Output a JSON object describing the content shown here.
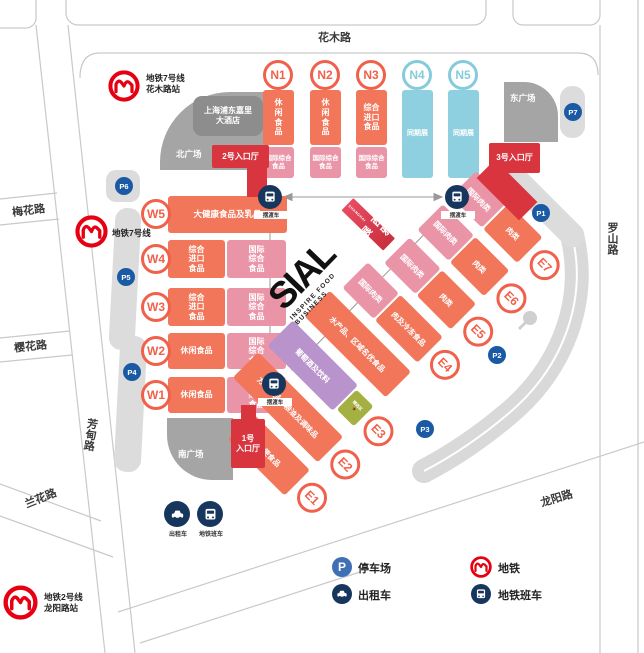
{
  "map": {
    "roads": {
      "huamu": "花木路",
      "meihua": "梅花路",
      "yinghua": "樱花路",
      "fangdian": "芳甸路",
      "lanhua": "兰花路",
      "luoshan": "罗山路",
      "longyang": "龙阳路"
    },
    "metro": {
      "line7_station": {
        "line1": "地铁7号线",
        "line2": "花木路站"
      },
      "line7": {
        "line1": "地铁7号线"
      },
      "line2_station": {
        "line1": "地铁2号线",
        "line2": "龙阳路站"
      }
    },
    "plazas": {
      "north": "北广场",
      "south": "南广场",
      "east": "东广场"
    },
    "hotel": {
      "line1": "上海浦东嘉里",
      "line2": "大酒店"
    },
    "entrances": {
      "hall2": "2号入口厅",
      "hall3": "3号入口厅",
      "hall1_line1": "1号",
      "hall1_line2": "入口厅"
    },
    "shuttle_label": "摆渡车",
    "taxi_label": "出租车",
    "metro_bus_label": "地铁班车",
    "parking": {
      "p1": "P1",
      "p2": "P2",
      "p3": "P3",
      "p4": "P4",
      "p5": "P5",
      "p6": "P6",
      "p7": "P7"
    }
  },
  "halls": {
    "n": [
      {
        "id": "N1",
        "top": "休闲食品",
        "bottom": "国际综合食品"
      },
      {
        "id": "N2",
        "top": "休闲食品",
        "bottom": "国际综合食品"
      },
      {
        "id": "N3",
        "top": "综合进口食品",
        "bottom": "国际综合食品"
      },
      {
        "id": "N4",
        "zone": "同期展"
      },
      {
        "id": "N5",
        "zone": "同期展"
      }
    ],
    "w": [
      {
        "id": "W5",
        "zone": "大健康食品及乳品"
      },
      {
        "id": "W4",
        "left": "综合进口食品",
        "right": "国际综合食品"
      },
      {
        "id": "W3",
        "left": "综合进口食品",
        "right": "国际综合食品"
      },
      {
        "id": "W2",
        "left": "休闲食品",
        "right": "国际综合食品"
      },
      {
        "id": "W1",
        "left": "休闲食品",
        "right": "国际综合食品"
      }
    ],
    "e": [
      {
        "id": "E7",
        "left": "国际肉类",
        "right": "肉类"
      },
      {
        "id": "E6",
        "left": "国际肉类",
        "right": "肉类"
      },
      {
        "id": "E5",
        "left": "国际肉类",
        "right": "肉类"
      },
      {
        "id": "E4",
        "left": "国际肉类",
        "right": "肉及冷冻食品"
      },
      {
        "zone": "水产品、区域名优食品"
      },
      {
        "id": "E3",
        "left": "葡萄酒及饮料",
        "special": "精选区",
        "star": "★"
      },
      {
        "id": "E2",
        "zone": "方便食品、粮油及调味品"
      },
      {
        "id": "E1",
        "zone": "方便食品"
      }
    ]
  },
  "logo": {
    "name": "SIAL",
    "sub": "SHANGHAI",
    "cn": "西雅展",
    "tagline": "INSPIRE FOOD BUSINESS"
  },
  "legend": {
    "parking": "停车场",
    "metro": "地铁",
    "taxi": "出租车",
    "metro_bus": "地铁班车"
  },
  "colors": {
    "hall_orange": "#f2765a",
    "hall_pink": "#ea94a8",
    "hall_blue": "#8ed0df",
    "entrance_red": "#d8353f",
    "wine_purple": "#b993cb",
    "special_green": "#a4b042",
    "icon_navy": "#17365d",
    "parking_blue": "#1a5aa5",
    "legend_blue": "#3f6fb5",
    "metro_red": "#e60012"
  }
}
